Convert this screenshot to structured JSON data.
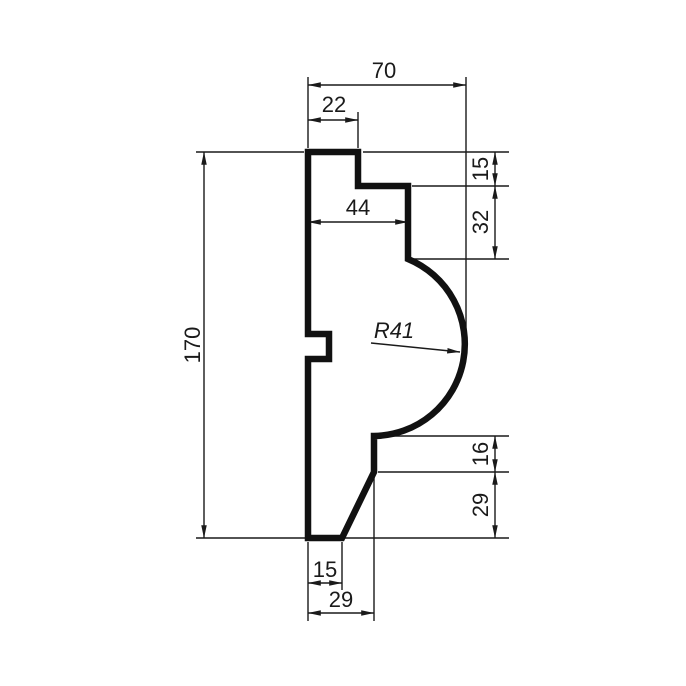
{
  "drawing": {
    "colors": {
      "line": "#1a1a1a",
      "background": "#ffffff"
    },
    "dimensions": {
      "overall_width": "70",
      "top_step_width": "22",
      "mid_face_width": "44",
      "overall_height": "170",
      "top_right_step_height": "15",
      "upper_right_face_height": "32",
      "cove_radius": "R41",
      "lower_right_face_height": "16",
      "lower_right_height": "29",
      "bottom_flat_width": "15",
      "bottom_overall_width": "29"
    }
  }
}
